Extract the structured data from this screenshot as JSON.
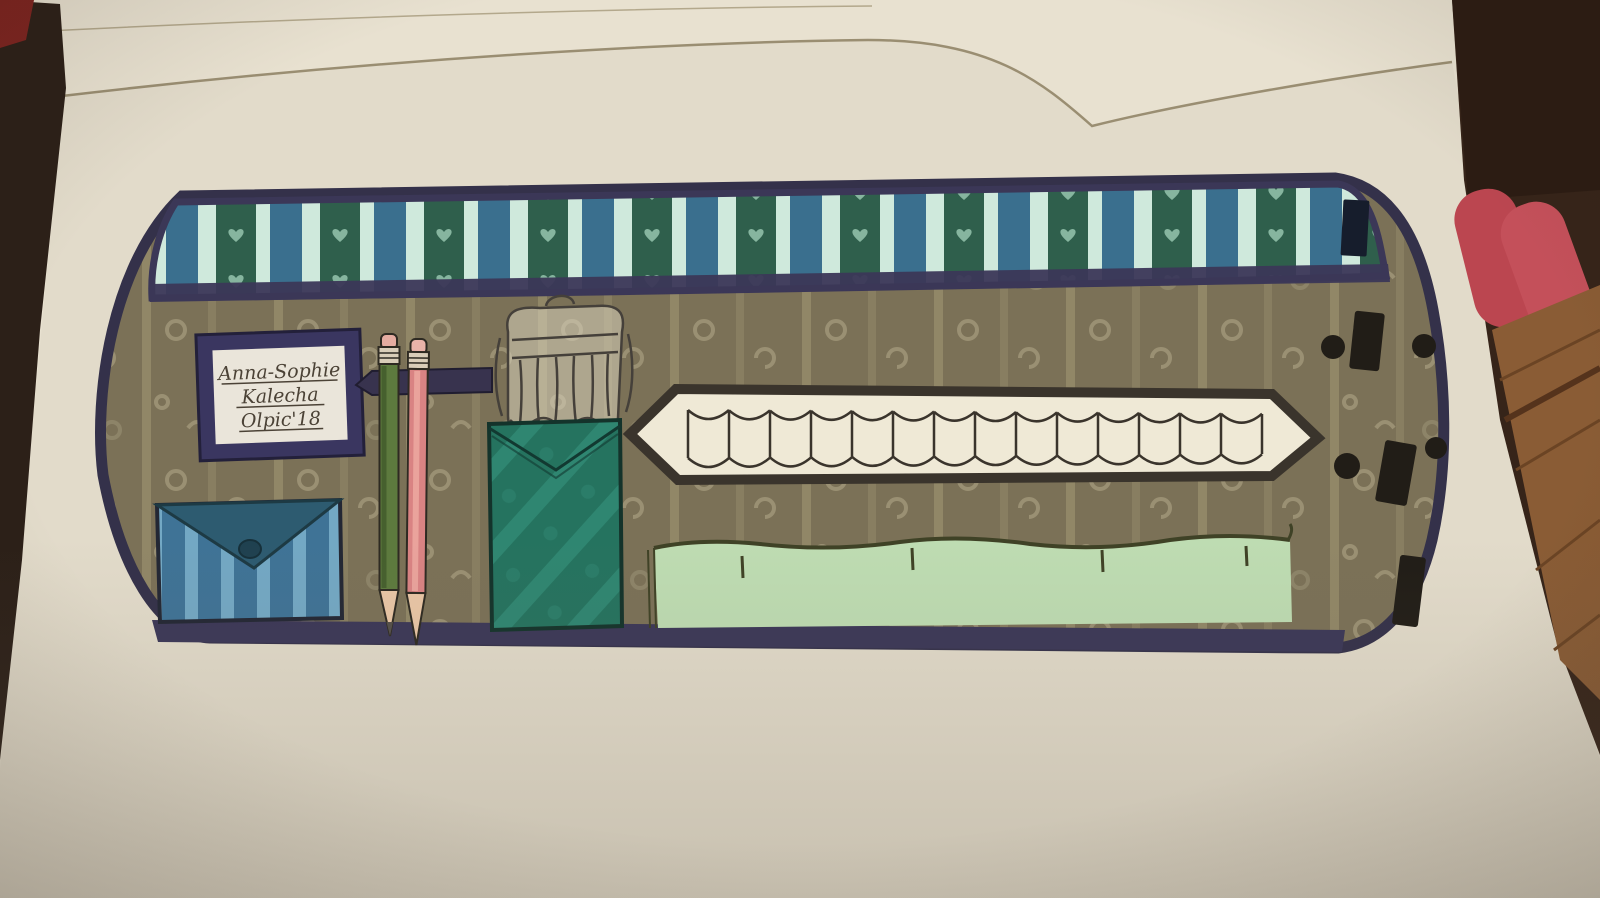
{
  "scene": {
    "type": "photograph",
    "subject": "Hand-drawn marker illustration of an opened pencil-case / roll-up organizer on a sketchbook page",
    "surface": "cream sketchbook paper lying on a dark wooden table",
    "background_objects": [
      "dark tabletop visible at left edge",
      "dark red sliver in top-left corner",
      "stacked page edges along the top",
      "dark wood and a red object at the right edge",
      "light wood grain at lower right"
    ]
  },
  "name_label": {
    "line1": "Anna-Sophie",
    "line2": "Kalecha",
    "line3": "Olpic'18"
  },
  "pencil_case": {
    "top_band": {
      "description": "striped fabric band with navy borders",
      "stripes": [
        "dark green with pale heart motifs",
        "pale mint",
        "steel blue",
        "pale mint"
      ],
      "detail": "small black rectangle near right end"
    },
    "body": {
      "description": "olive-khaki fabric with pale vertical stripes and swirl motifs",
      "bottom_border": "dark navy"
    },
    "contents": {
      "pencils": [
        {
          "body_color_name": "green",
          "eraser": "pink",
          "tip": "sharpened"
        },
        {
          "body_color_name": "pink",
          "eraser": "pink",
          "tip": "sharpened"
        }
      ],
      "pencil_strap": "navy elastic band holding the two pencils",
      "envelope_pocket": {
        "description": "blue striped envelope pocket with darker flap and button"
      },
      "brush_package": {
        "description": "ink-sketched hanging card of brushes, left uncolored"
      },
      "teal_pocket": {
        "description": "teal fabric pouch below the brush card"
      },
      "loop_strip": {
        "description": "long double-pointed strip of white elastic loops",
        "loops": 14
      },
      "green_pocket": {
        "description": "long pale-green pocket with wavy elastic top edge"
      },
      "fasteners": {
        "black_rectangles": 3,
        "black_dots": 4,
        "description": "velcro strips and snap dots on right flap"
      }
    }
  },
  "colors": {
    "paper": "#e2dbca",
    "pages": "#e8e1d0",
    "table-dark": "#2c2018",
    "wood-dark": "#362419",
    "wood-light": "#8a5c35",
    "red-corner": "#7e2420",
    "red-object": "#bb4650",
    "case-outline": "#34314a",
    "navy-border": "#3b3757",
    "olive": "#7b7157",
    "olive-stripe": "#968c6c",
    "olive-swirl": "#a79d7e",
    "stripe-green": "#2f5f4c",
    "stripe-mint": "#cfe9dc",
    "stripe-blue": "#3a6f8e",
    "heart": "#9ccbb4",
    "label-frame": "#3a3660",
    "label-card": "#eae5da",
    "ink": "#4b4236",
    "pocket-blue": "#3f7396",
    "pocket-blue-stripe": "#79aec9",
    "pocket-flap": "#2d5b70",
    "strap-navy": "#38334e",
    "pencil-green": "#5d7a3e",
    "pencil-pink": "#d98383",
    "eraser": "#e5aca1",
    "ferrule": "#d9cdb9",
    "wood-tip": "#e9c6a6",
    "teal": "#25735f",
    "teal-stripe": "#2f8671",
    "loop-fill": "#efe9d6",
    "loop-line": "#3a342c",
    "green-pocket": "#bedcb2",
    "fastener-black": "#211d17"
  }
}
